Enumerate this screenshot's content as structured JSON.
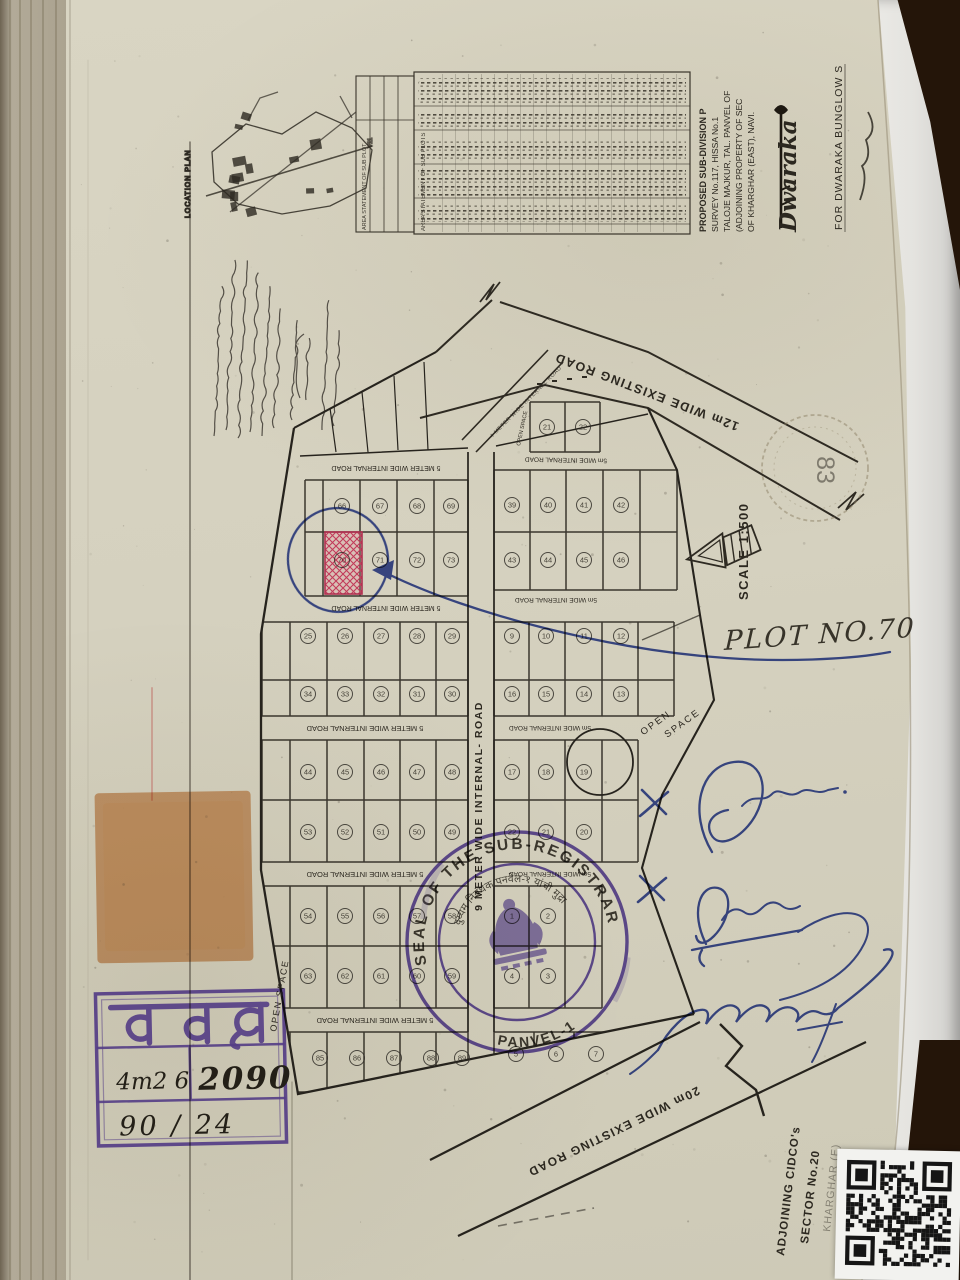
{
  "document": {
    "location_plan_label": "LOCATION PLAN",
    "area_statement_label": "AREA STATEMENT OF SUB PLOT",
    "area_statement_label2": "AREA STATEMENT OF SUB PLOTS",
    "title_lines": [
      "PROPOSED SUB-DIVISION P",
      "SURVEY No.117, HISSA No.1",
      "TALOJE MAJKUR, TAL. PANVEL OF",
      "(ADJOINING PROPERTY OF SEC",
      "OF KHARGHAR (EAST), NAVI."
    ],
    "brand_script": "Dwaraka",
    "for_line": "FOR DWARAKA BUNGLOW S",
    "scale_label": "SCALE 1:500",
    "faded_stamp_number": "83"
  },
  "map": {
    "roads": {
      "existing12": "12m WIDE EXISTING ROAD",
      "existing20": "20m WIDE EXISTING ROAD",
      "internal9": "9 METER WIDE INTERNAL- ROAD",
      "internal5": "5 METER WIDE INTERNAL ROAD",
      "internal5m": "5m WIDE INTERNAL ROAD",
      "internal4": "4 METER WIDE INTERNAL ROAD"
    },
    "open_space": "OPEN SPACE",
    "open_space_words": [
      "OPEN",
      "SPACE"
    ],
    "highlight_plot": "70",
    "plot_numbers": {
      "tl_r1": [
        "66",
        "67",
        "68",
        "69"
      ],
      "tl_r2": [
        "70",
        "71",
        "72",
        "73"
      ],
      "tr_small": [
        "21",
        "22"
      ],
      "tr_r1": [
        "39",
        "40",
        "41",
        "42"
      ],
      "tr_r2": [
        "43",
        "44",
        "45",
        "46"
      ],
      "lb1_r1": [
        "25",
        "26",
        "27",
        "28",
        "29"
      ],
      "lb1_r2": [
        "34",
        "33",
        "32",
        "31",
        "30"
      ],
      "lb2_r1": [
        "44",
        "45",
        "46",
        "47",
        "48"
      ],
      "lb2_r2": [
        "53",
        "52",
        "51",
        "50",
        "49"
      ],
      "lb3_r1": [
        "54",
        "55",
        "56",
        "57",
        "58"
      ],
      "lb3_r2": [
        "63",
        "62",
        "61",
        "60",
        "59"
      ],
      "lb4": [
        "85",
        "86",
        "87",
        "88",
        "89"
      ],
      "rb1_r1": [
        "9",
        "10",
        "11",
        "12"
      ],
      "rb1_r2": [
        "16",
        "15",
        "14",
        "13"
      ],
      "rb2_r1": [
        "17",
        "18",
        "19"
      ],
      "rb2_r2": [
        "22",
        "21",
        "20"
      ],
      "rb3_r1": [
        "1",
        "2"
      ],
      "rb3_r2": [
        "4",
        "3"
      ],
      "rb4": [
        "5",
        "6",
        "7"
      ]
    }
  },
  "annotations": {
    "plot_note": "PLOT NO.70",
    "adjoining_lines": [
      "ADJOINING CIDCO's",
      "SECTOR No.20",
      "KHARGHAR (E)"
    ]
  },
  "seal": {
    "top_text": "SEAL OF THE SUB-REGISTRAR",
    "bottom_text": "PANVEL-1",
    "inner_text": "दुय्यम निबंधक पनवेल-१ यांची मुद्रा"
  },
  "stamp_box": {
    "title": "पवल",
    "ref_handwritten": "4m2 6",
    "year": "२०१०",
    "year_lookalike": "2090",
    "serial": "90 / 24"
  },
  "colors": {
    "page": "#d6d2c0",
    "ink": "#2c2820",
    "pen_blue": "#2b3f9e",
    "stamp_purple": "#5a41ad",
    "plot_red": "#c23b5a",
    "patch_orange": "#d8965e",
    "wood": "#35261a"
  }
}
